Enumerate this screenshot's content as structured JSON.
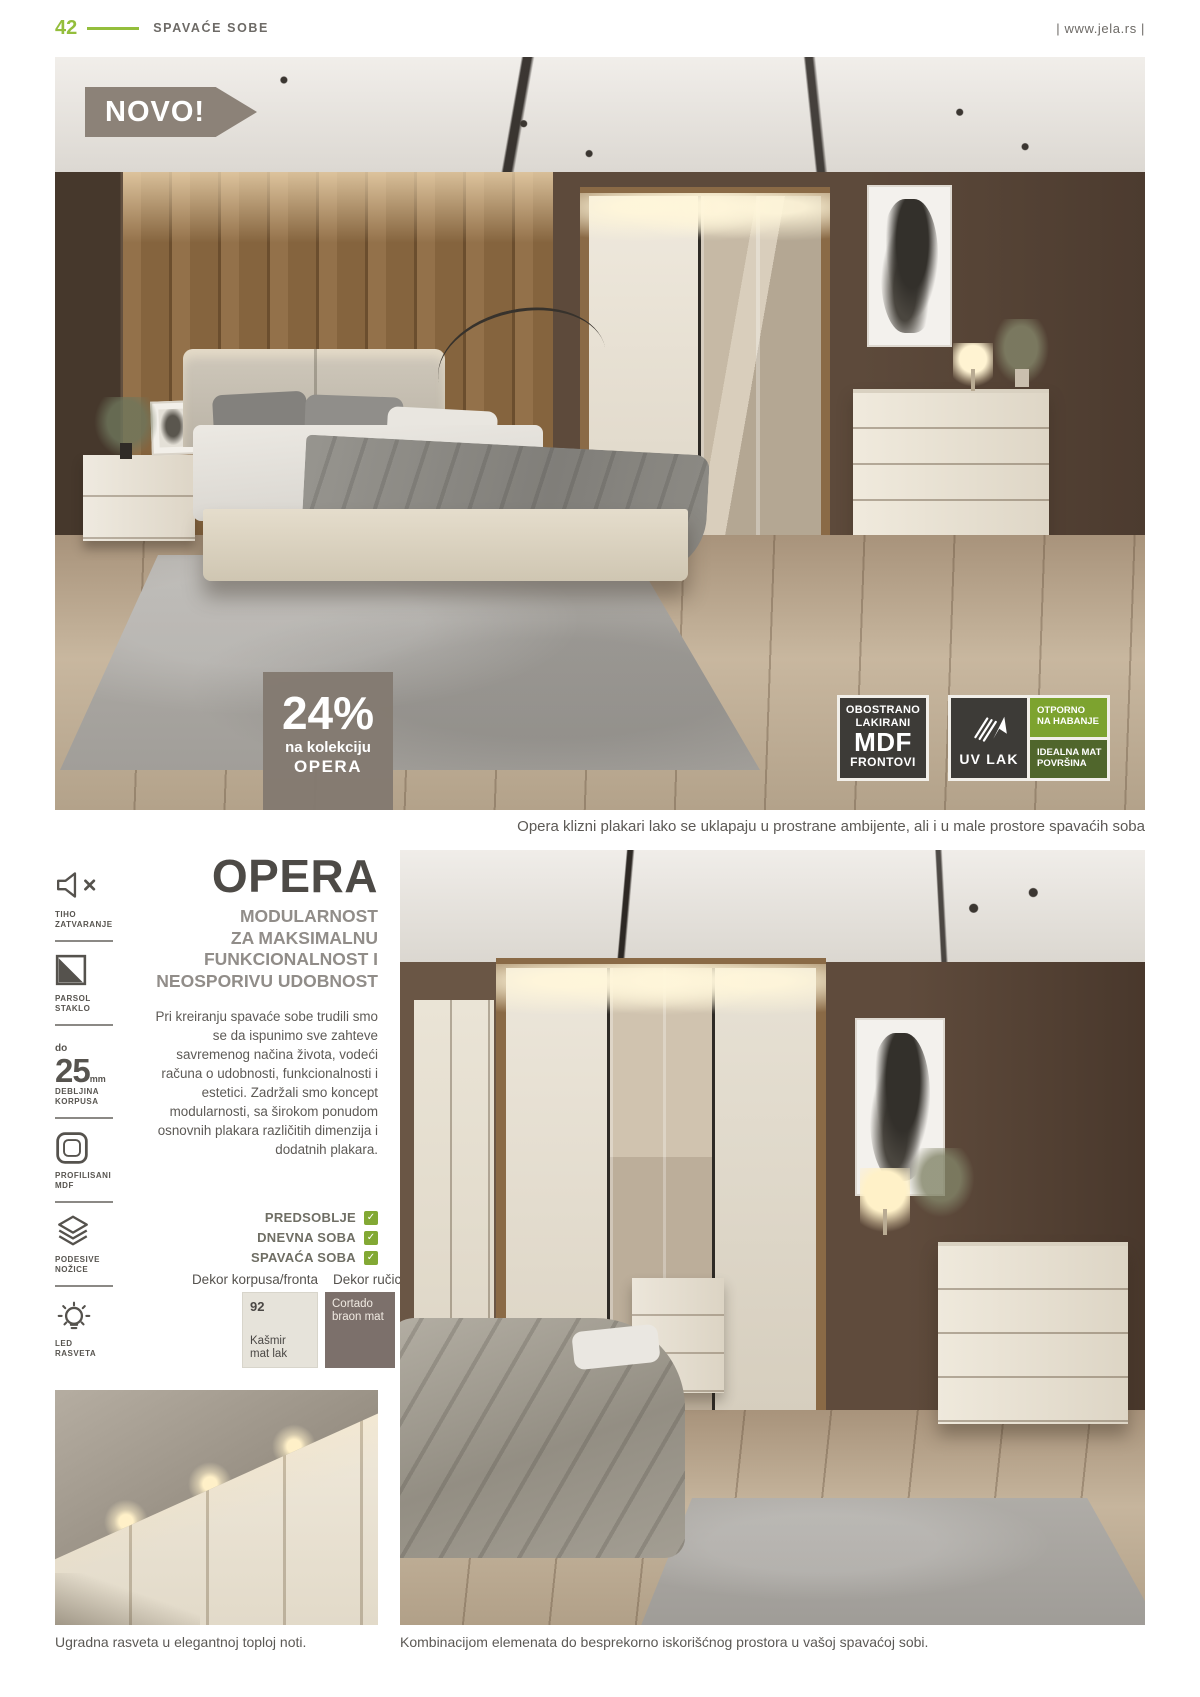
{
  "header": {
    "page_number": "42",
    "section_title": "SPAVAĆE SOBE",
    "website": "| www.jela.rs |"
  },
  "hero": {
    "novo_badge": "NOVO!",
    "discount_badge": {
      "percent": "24%",
      "line1": "na kolekciju",
      "line2": "OPERA"
    },
    "quality_badges": {
      "mdf": [
        "OBOSTRANO",
        "LAKIRANI",
        "MDF",
        "FRONTOVI"
      ],
      "uv_lak": "UV LAK",
      "uv_icon": "brush-arrow-icon",
      "wear_top": [
        "OTPORNO",
        "NA HABANJE"
      ],
      "wear_bottom": [
        "IDEALNA MAT",
        "POVRŠINA"
      ]
    },
    "caption": "Opera klizni plakari lako se uklapaju u prostrane ambijente, ali i u male prostore spavaćih soba"
  },
  "features": [
    {
      "icon": "mute-speaker-icon",
      "line1": "TIHO",
      "line2": "ZATVARANJE"
    },
    {
      "icon": "glass-pane-icon",
      "line1": "PARSOL",
      "line2": "STAKLO"
    },
    {
      "icon": "thickness-value",
      "prefix": "do",
      "value": "25",
      "unit": "mm",
      "line1": "DEBLJINA",
      "line2": "KORPUSA"
    },
    {
      "icon": "profiled-panel-icon",
      "line1": "PROFILISANI",
      "line2": "MDF"
    },
    {
      "icon": "layers-icon",
      "line1": "PODESIVE",
      "line2": "NOŽICE"
    },
    {
      "icon": "bulb-icon",
      "line1": "LED",
      "line2": "RASVETA"
    }
  ],
  "collection": {
    "title": "OPERA",
    "subtitle_lines": [
      "MODULARNOST",
      "ZA MAKSIMALNU",
      "FUNKCIONALNOST I",
      "NEOSPORIVU UDOBNOST"
    ],
    "description": "Pri kreiranju spavaće sobe trudili smo se da ispunimo sve zahteve savremenog načina života, vodeći računa o udobnosti, funkcionalnosti i estetici. Zadržali smo koncept modularnosti, sa širokom ponudom osnovnih plakara različitih dimenzija i dodatnih plakara.",
    "check_glyph": "✓",
    "rooms": [
      {
        "label": "PREDSOBLJE"
      },
      {
        "label": "DNEVNA SOBA"
      },
      {
        "label": "SPAVAĆA SOBA"
      }
    ]
  },
  "decors": {
    "front_header": "Dekor korpusa/fronta",
    "handle_header": "Dekor ručice",
    "front_swatch": {
      "code": "92",
      "name_line1": "Kašmir",
      "name_line2": "mat lak",
      "color": "#e6e3da"
    },
    "handle_swatch": {
      "name_line1": "Cortado",
      "name_line2": "braon mat",
      "color": "#7c706b"
    }
  },
  "footer_captions": {
    "left": "Ugradna rasveta u elegantnoj toploj noti.",
    "right": "Kombinacijom elemenata do besprekorno iskorišćnog prostora u vašoj spavaćoj sobi."
  },
  "colors": {
    "accent_green": "#94be3c",
    "check_green": "#82a834",
    "badge_green_top": "#7da32f",
    "badge_green_bottom": "#50662c",
    "badge_dark": "#3d3b37",
    "novo_gray": "#8c8278",
    "discount_gray": "#837a71"
  }
}
